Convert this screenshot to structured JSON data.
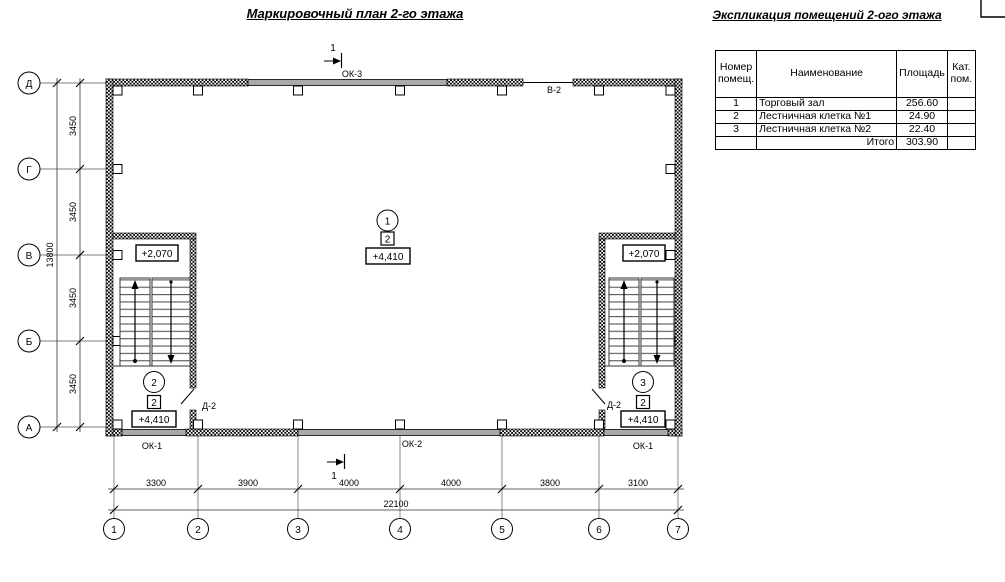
{
  "plan": {
    "title": "Маркировочный план 2-го этажа",
    "row_axes": [
      "Д",
      "Г",
      "В",
      "Б",
      "А"
    ],
    "col_axes": [
      "1",
      "2",
      "3",
      "4",
      "5",
      "6",
      "7"
    ],
    "dims_left_segments": [
      "3450",
      "3450",
      "3450",
      "3450"
    ],
    "dim_left_total": "13800",
    "dims_bottom_segments": [
      "3300",
      "3900",
      "4000",
      "4000",
      "3800",
      "3100"
    ],
    "dim_bottom_total": "22100",
    "section_mark_top": "1",
    "section_mark_bottom": "1",
    "labels": {
      "ok3": "ОК-3",
      "v2": "В-2",
      "ok1_left": "ОК-1",
      "ok2": "ОК-2",
      "ok1_right": "ОК-1",
      "d2_left": "Д-2",
      "d2_right": "Д-2",
      "elev_left_upper": "+2,070",
      "elev_right_upper": "+2,070",
      "elev_center": "+4,410",
      "elev_left_lower": "+4,410",
      "elev_right_lower": "+4,410",
      "room_center_num": "1",
      "room_left_num": "2",
      "room_right_num": "3",
      "cat_center": "2",
      "cat_left": "2",
      "cat_right": "2"
    }
  },
  "explication": {
    "title": "Экспликация помещений 2-ого этажа",
    "headers": {
      "num": "Номер помещ.",
      "name": "Наименование",
      "area": "Площадь",
      "cat": "Кат. пом."
    },
    "rows": [
      {
        "num": "1",
        "name": "Торговый зал",
        "area": "256.60",
        "cat": ""
      },
      {
        "num": "2",
        "name": "Лестничная клетка №1",
        "area": "24.90",
        "cat": ""
      },
      {
        "num": "3",
        "name": "Лестничная клетка №2",
        "area": "22.40",
        "cat": ""
      },
      {
        "num": "",
        "name": "Итого",
        "area": "303.90",
        "cat": ""
      }
    ]
  }
}
